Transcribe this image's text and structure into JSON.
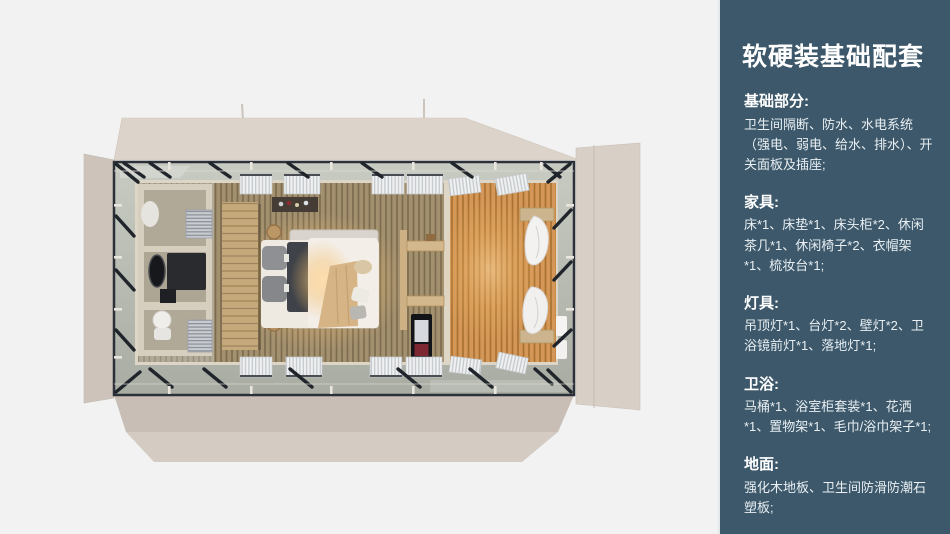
{
  "slide": {
    "background_color": "#f2f2f2"
  },
  "sidebar": {
    "background_color": "#3c586a",
    "heading_color": "#ffffff",
    "body_color": "#e9eff3",
    "title": "软硬装基础配套",
    "sections": [
      {
        "heading": "基础部分:",
        "body": "卫生间隔断、防水、水电系统（强电、弱电、给水、排水）、开关面板及插座;"
      },
      {
        "heading": "家具:",
        "body": "床*1、床垫*1、床头柜*2、休闲茶几*1、休闲椅子*2、衣帽架*1、梳妆台*1;"
      },
      {
        "heading": "灯具:",
        "body": "吊顶灯*1、台灯*2、壁灯*2、卫浴镜前灯*1、落地灯*1;"
      },
      {
        "heading": "卫浴:",
        "body": "马桶*1、浴室柜套装*1、花洒*1、置物架*1、毛巾/浴巾架子*1;"
      },
      {
        "heading": "地面:",
        "body": "强化木地板、卫生间防滑防潮石塑板;"
      }
    ]
  },
  "floorplan": {
    "colors": {
      "hull": "#d8d0c6",
      "steel_frame": "#2c3038",
      "deck": "#b9bdb2",
      "bedroom_floor": "#a3906f",
      "warm_room_floor": "#cf9a55",
      "bathroom_wall": "#d6cebe",
      "lamp_glow": "#ffd9a0"
    }
  }
}
